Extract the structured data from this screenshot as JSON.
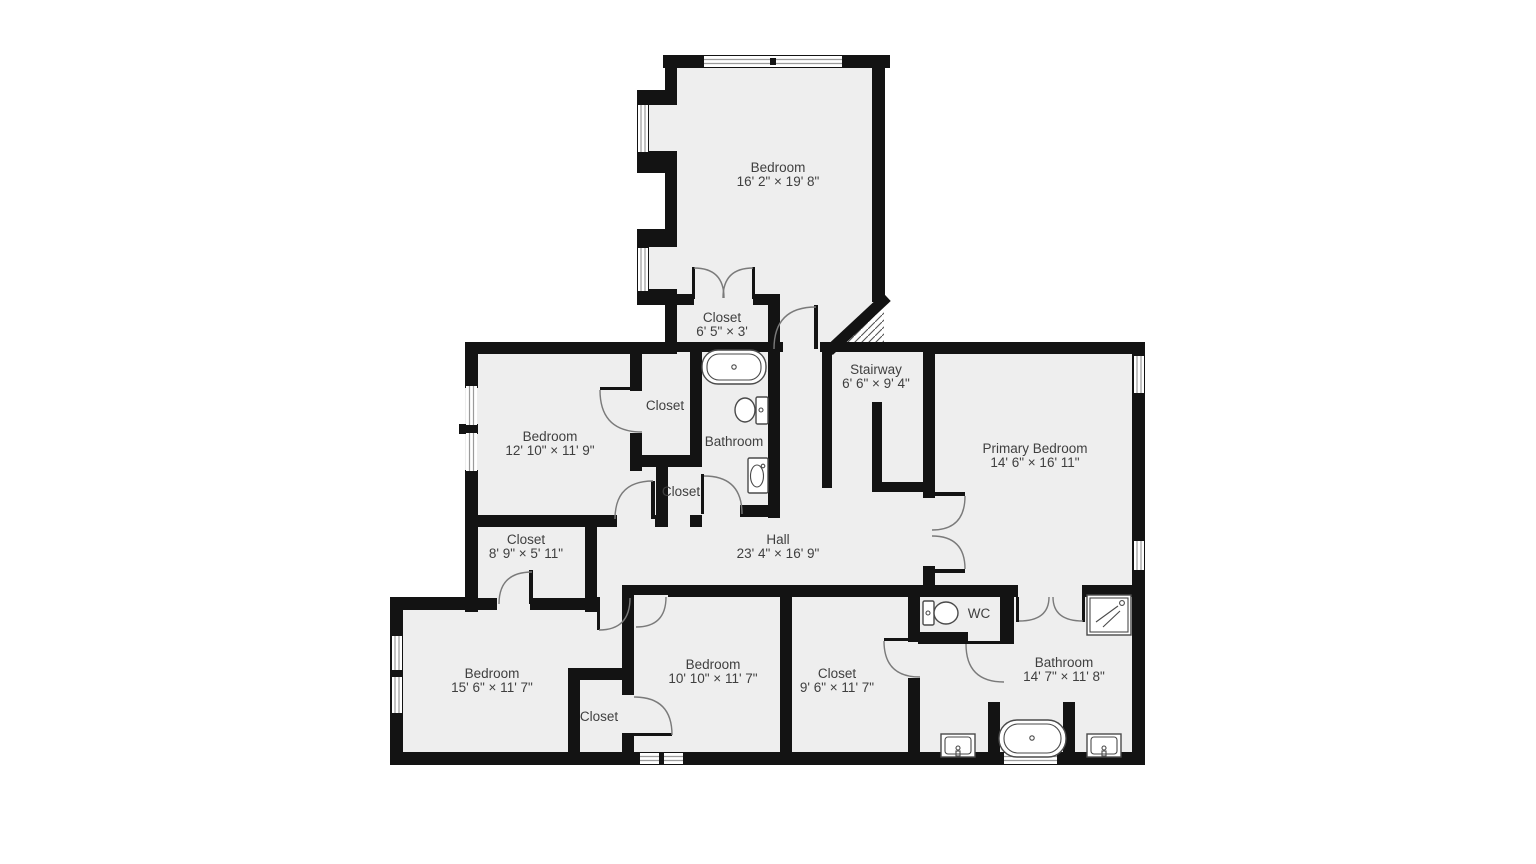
{
  "plan": {
    "type": "floor-plan",
    "colors": {
      "wall": "#131313",
      "floor": "#eeeeee",
      "background": "#ffffff",
      "label": "#3f3f3f"
    },
    "rooms": [
      {
        "name": "Bedroom",
        "dims": "16' 2\" × 19' 8\""
      },
      {
        "name": "Closet",
        "dims": "6' 5\" × 3'"
      },
      {
        "name": "Stairway",
        "dims": "6' 6\" × 9' 4\""
      },
      {
        "name": "Closet",
        "dims": ""
      },
      {
        "name": "Bedroom",
        "dims": "12' 10\" × 11' 9\""
      },
      {
        "name": "Bathroom",
        "dims": ""
      },
      {
        "name": "Closet",
        "dims": ""
      },
      {
        "name": "Primary Bedroom",
        "dims": "14' 6\" × 16' 11\""
      },
      {
        "name": "Closet",
        "dims": "8' 9\" × 5' 11\""
      },
      {
        "name": "Hall",
        "dims": "23' 4\" × 16' 9\""
      },
      {
        "name": "Bedroom",
        "dims": "15' 6\" × 11' 7\""
      },
      {
        "name": "Bedroom",
        "dims": "10' 10\" × 11' 7\""
      },
      {
        "name": "Closet",
        "dims": "9' 6\" × 11' 7\""
      },
      {
        "name": "WC",
        "dims": ""
      },
      {
        "name": "Bathroom",
        "dims": "14' 7\" × 11' 8\""
      },
      {
        "name": "Closet",
        "dims": ""
      }
    ],
    "fixtures": [
      "bathtub",
      "toilet",
      "sink",
      "toilet",
      "shower",
      "bathtub",
      "sink",
      "sink"
    ],
    "features": [
      "windows",
      "door-swings",
      "stair-hatch"
    ]
  }
}
